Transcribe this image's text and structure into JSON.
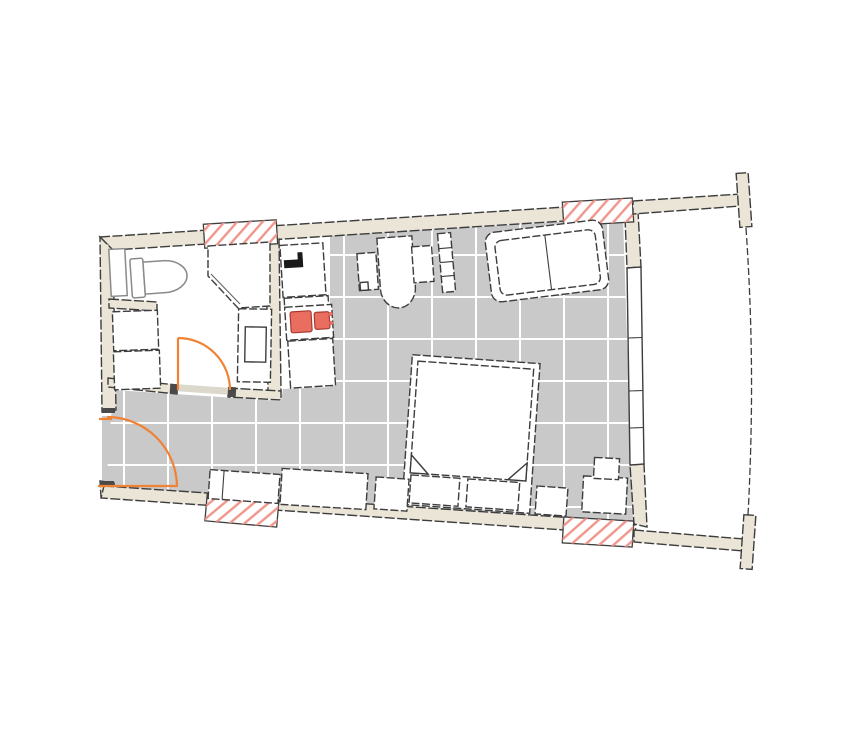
{
  "meta": {
    "type": "architectural floor plan",
    "description": "Studio apartment floor plan (no text labels visible): bathroom and kitchenette on the left, open living/sleeping room with tiled floor, balcony with curved railing on the right",
    "visible_text": ""
  },
  "colors": {
    "background": "#ffffff",
    "wall-fill": "#eae5d7",
    "outline": "#3d3d3d",
    "floor-tile": "#c9c9c9",
    "tile-grid": "#ffffff",
    "hatch-red": "#f0958b",
    "burner-red": "#e96e60",
    "burner-outline": "#a83a32",
    "door-orange": "#f08236",
    "furniture-fill": "#ffffff",
    "fixture-gray": "#8a8a8a",
    "jamb-dark": "#4a4a4a",
    "faucet-black": "#1a1a1a",
    "glass": "#666666",
    "threshold": "#dcd8cb"
  },
  "rooms": [
    {
      "id": "bathroom",
      "fixtures": [
        "toilet",
        "shower",
        "vanity-sink",
        "washer-cabinet",
        "radiator-shelf"
      ]
    },
    {
      "id": "kitchenette",
      "fixtures": [
        "sink-counter",
        "stove-two-burners",
        "base-cabinet"
      ]
    },
    {
      "id": "hallway",
      "fixtures": [
        "entrance-door"
      ]
    },
    {
      "id": "living-sleeping-room",
      "fixtures": [
        "desk",
        "desk-chair",
        "wall-shelf",
        "sofa",
        "double-bed",
        "pillows",
        "sideboard-benches",
        "nightstand"
      ]
    },
    {
      "id": "balcony",
      "fixtures": [
        "railing",
        "side-walls"
      ]
    }
  ],
  "markings": {
    "door_swing_arcs": 2,
    "red_hatched_wall_openings": 4,
    "floor_tile_grid": true,
    "window_band_right_wall": true
  }
}
